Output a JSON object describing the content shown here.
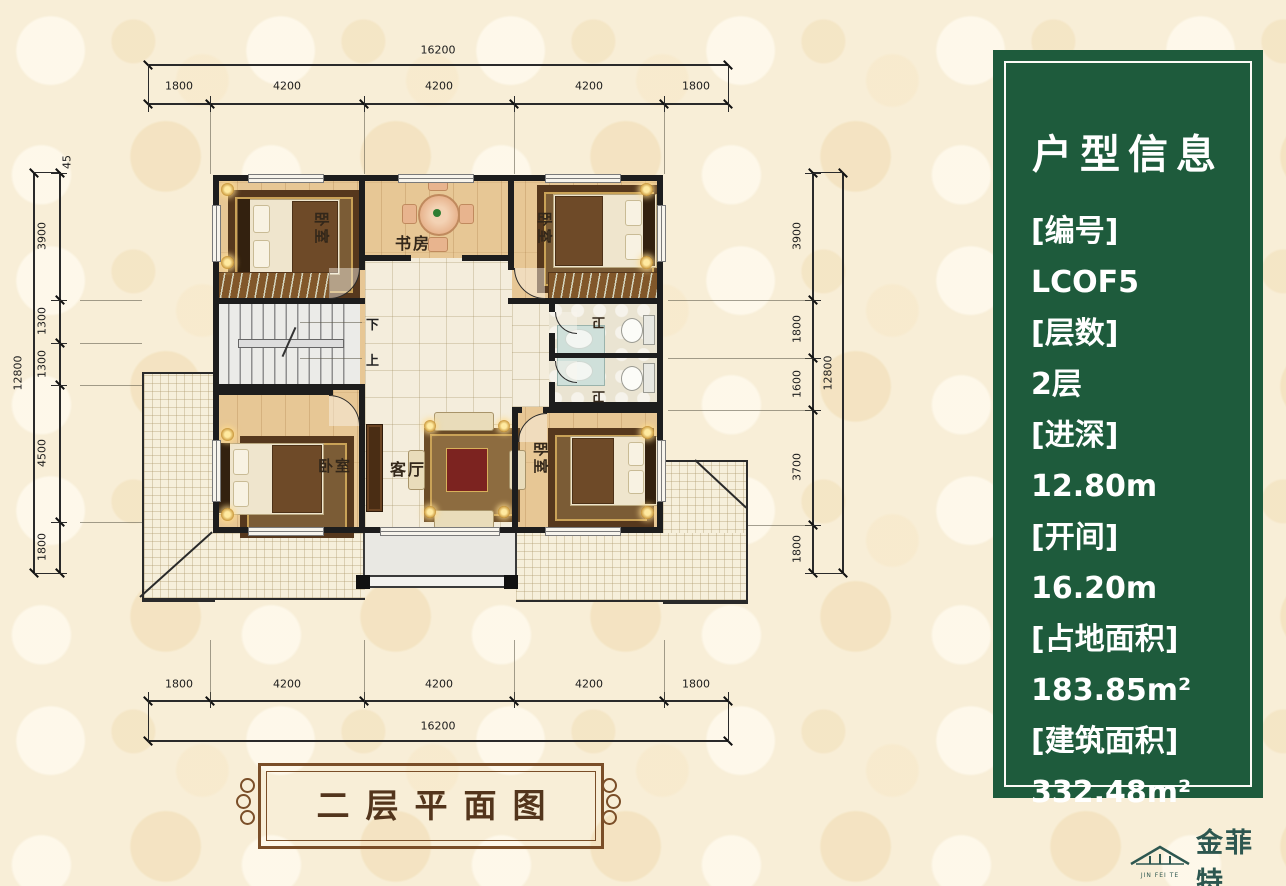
{
  "colors": {
    "background": "#f8eed7",
    "panel_green": "#1e5b3c",
    "wall": "#1d1d1d",
    "frame_brown": "#7a4e28",
    "logo_green": "#2d5750"
  },
  "dimensions": {
    "top": {
      "total": "16200",
      "segments": [
        "1800",
        "4200",
        "4200",
        "4200",
        "1800"
      ]
    },
    "bottom": {
      "total": "16200",
      "segments": [
        "1800",
        "4200",
        "4200",
        "4200",
        "1800"
      ]
    },
    "left": {
      "total": "12800",
      "offset_top": "45",
      "segments": [
        "3900",
        "1300",
        "1300",
        "4500",
        "1800"
      ]
    },
    "right": {
      "total": "12800",
      "segments": [
        "3900",
        "1800",
        "1600",
        "3700",
        "1800"
      ]
    }
  },
  "plan": {
    "rooms": {
      "bedroom_tl": "卧室",
      "study": "书房",
      "bedroom_tr": "卧室",
      "bath_upper": "卫",
      "bath_lower": "卫",
      "bedroom_bl": "卧室",
      "living": "客厅",
      "bedroom_br": "卧室"
    },
    "stairs": {
      "down": "下",
      "up": "上"
    }
  },
  "info_panel": {
    "title": "户型信息",
    "items": [
      {
        "label": "[编号]",
        "value": "LCOF5"
      },
      {
        "label": "[层数]",
        "value": "2层"
      },
      {
        "label": "[进深]",
        "value": "12.80m"
      },
      {
        "label": "[开间]",
        "value": "16.20m"
      },
      {
        "label": "[占地面积]",
        "value": "183.85m²"
      },
      {
        "label": "[建筑面积]",
        "value": "332.48m²"
      }
    ]
  },
  "caption": {
    "text": "二层平面图"
  },
  "logo": {
    "name": "金菲特",
    "caption": "JIN FEI TE"
  }
}
